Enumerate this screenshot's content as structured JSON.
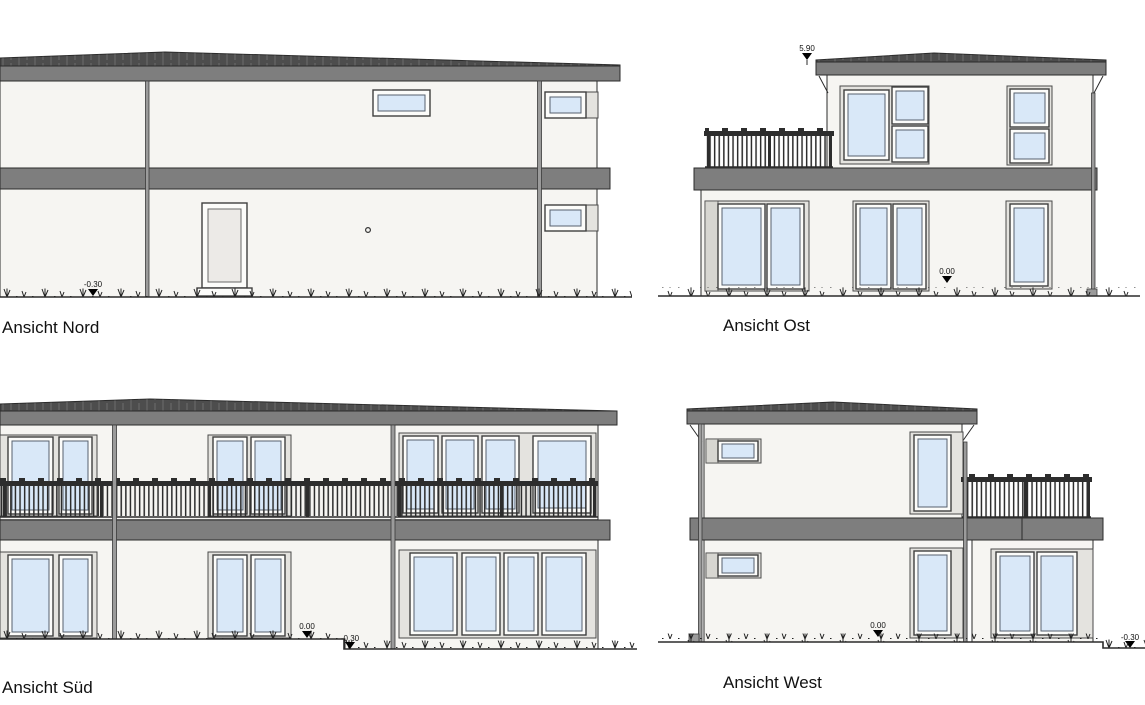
{
  "drawing": {
    "type": "architectural-elevations",
    "views": {
      "nord": {
        "label": "Ansicht Nord",
        "marker_ground": "-0.30"
      },
      "ost": {
        "label": "Ansicht Ost",
        "marker_roof": "5.90",
        "marker_floor": "0.00"
      },
      "sued": {
        "label": "Ansicht Süd",
        "marker_floor": "0.00",
        "marker_ground": "-0.30"
      },
      "west": {
        "label": "Ansicht West",
        "marker_floor": "0.00",
        "marker_ground": "-0.30"
      }
    },
    "colors": {
      "background": "#ffffff",
      "wall": "#f6f5f2",
      "slab": "#7e7e7e",
      "roof": "#4d4d4d",
      "glass": "#d9e8f8",
      "frame": "#fcfcfa",
      "casing": "#e4e3df",
      "shutter_strip": "#d7d6d1",
      "railing": "#2d2d2d",
      "pipe": "#9b9b9b",
      "line": "#2b2b2b",
      "text": "#111111"
    }
  }
}
